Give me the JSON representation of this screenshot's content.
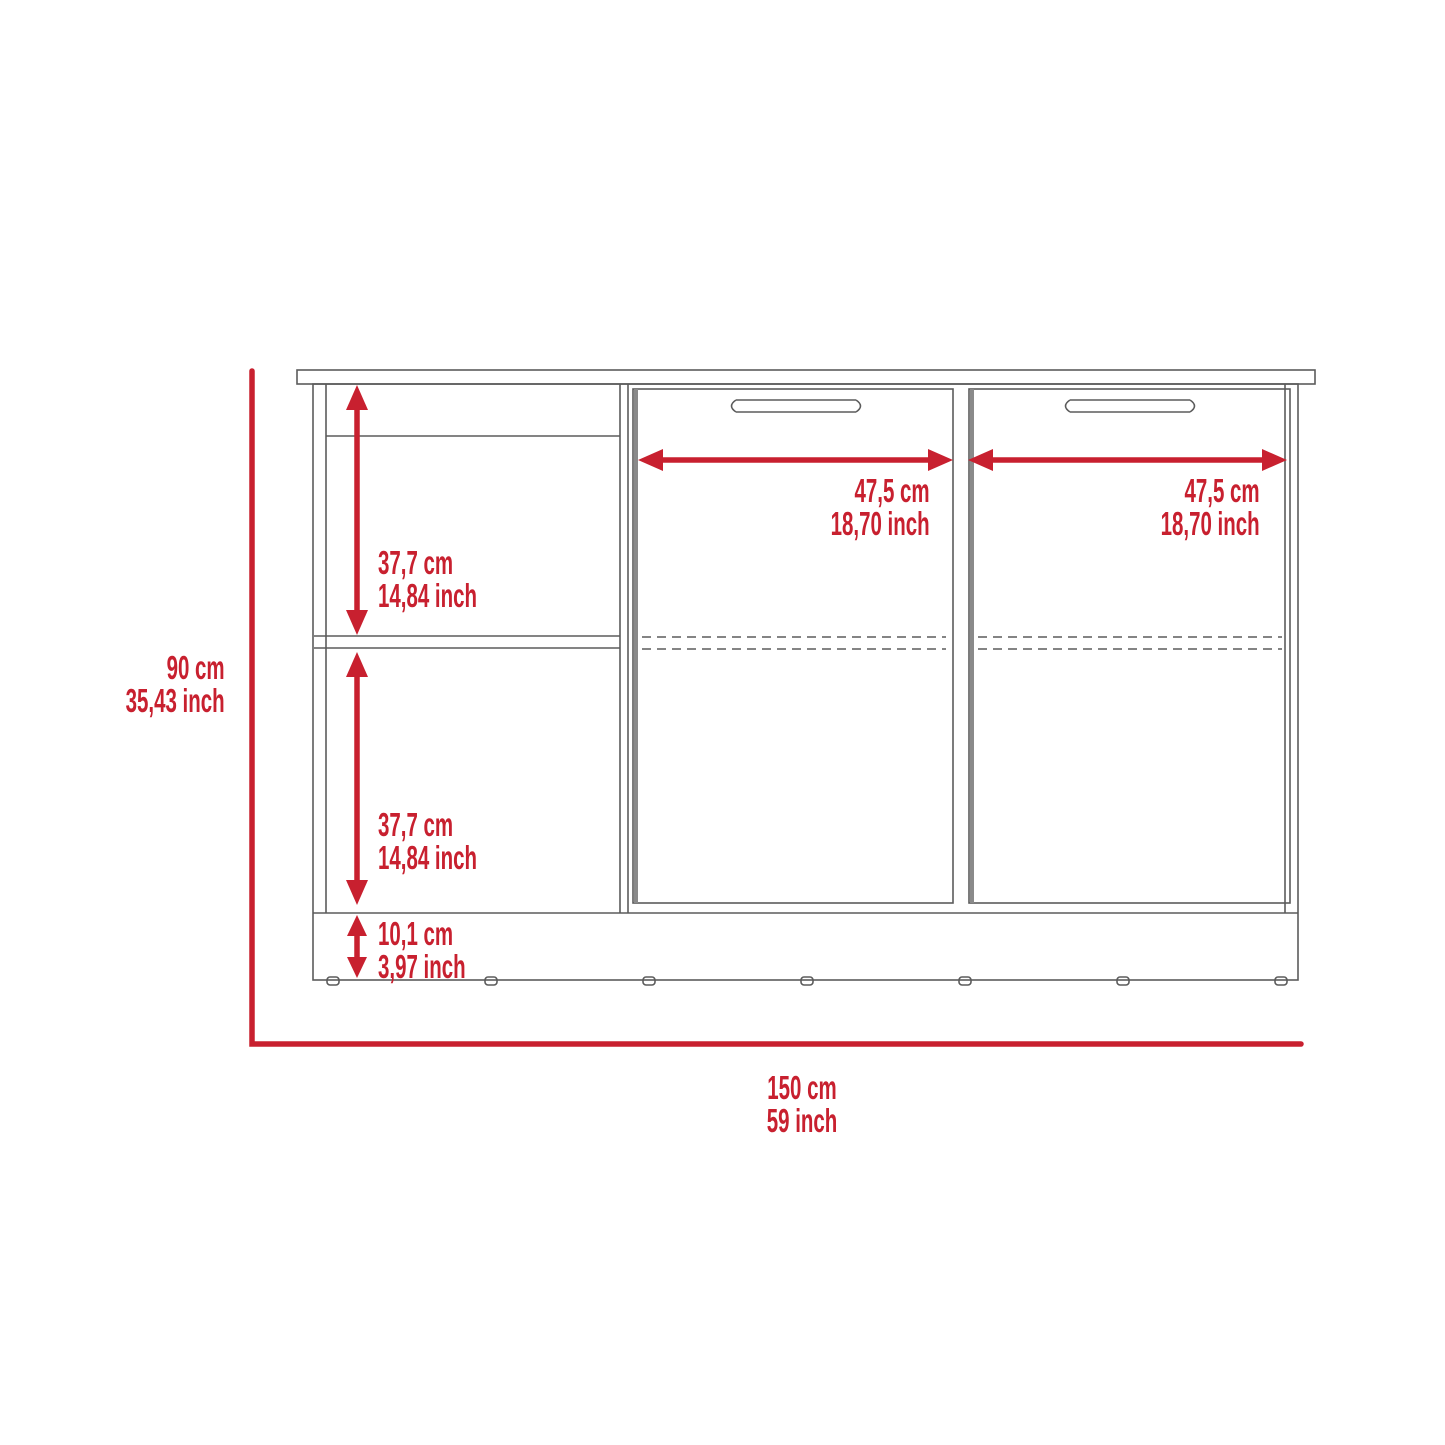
{
  "diagram": {
    "colors": {
      "dimension_red": "#C8202F",
      "line_gray": "#5B5B5B",
      "door_edge_gray": "#8a8a8a"
    },
    "dimensions": {
      "overall_height": {
        "cm": "90 cm",
        "inch": "35,43 inch"
      },
      "overall_width": {
        "cm": "150 cm",
        "inch": "59 inch"
      },
      "upper_compartment_height": {
        "cm": "37,7 cm",
        "inch": "14,84 inch"
      },
      "lower_compartment_height": {
        "cm": "37,7 cm",
        "inch": "14,84 inch"
      },
      "base_height": {
        "cm": "10,1 cm",
        "inch": "3,97 inch"
      },
      "left_door_width": {
        "cm": "47,5 cm",
        "inch": "18,70 inch"
      },
      "right_door_width": {
        "cm": "47,5 cm",
        "inch": "18,70 inch"
      }
    }
  }
}
